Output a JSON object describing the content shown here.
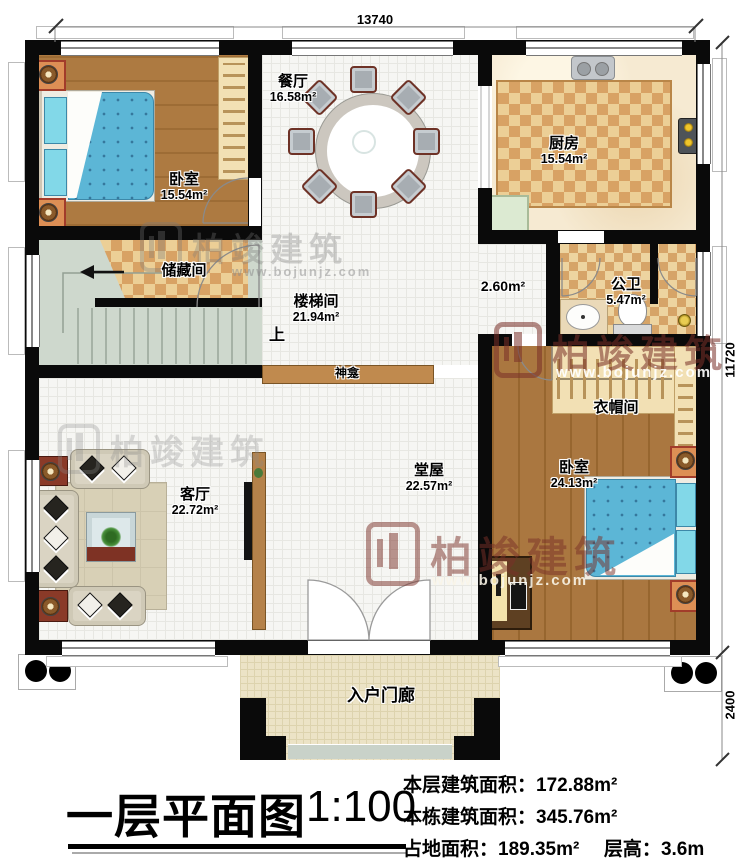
{
  "dimensions": {
    "top": "13740",
    "right_main": "11720",
    "right_porch": "2400"
  },
  "rooms": {
    "bedroom1": {
      "name": "卧室",
      "area": "15.54m²"
    },
    "dining": {
      "name": "餐厅",
      "area": "16.58m²"
    },
    "kitchen": {
      "name": "厨房",
      "area": "15.54m²"
    },
    "storage": {
      "name": "储藏间"
    },
    "stairwell": {
      "name": "楼梯间",
      "area": "21.94m²"
    },
    "corridor": {
      "area": "2.60m²"
    },
    "bathroom": {
      "name": "公卫",
      "area": "5.47m²"
    },
    "cloakroom": {
      "name": "衣帽间"
    },
    "bedroom2": {
      "name": "卧室",
      "area": "24.13m²"
    },
    "hall": {
      "name": "堂屋",
      "area": "22.57m²"
    },
    "living": {
      "name": "客厅",
      "area": "22.72m²"
    },
    "porch": {
      "name": "入户门廊"
    }
  },
  "annotations": {
    "up": "上",
    "shrine": "神龛"
  },
  "watermark": {
    "brand": "柏竣建筑",
    "url": "www.bojunjz.com"
  },
  "titleblock": {
    "title": "一层平面图",
    "scale": "1:100",
    "stat1_label": "本层建筑面积：",
    "stat1_value": "172.88m²",
    "stat2_label": "本栋建筑面积：",
    "stat2_value": "345.76m²",
    "stat3_label": "占地面积：",
    "stat3_value": "189.35m²",
    "stat4_label": "层高：",
    "stat4_value": "3.6m"
  },
  "colors": {
    "wall": "#0a0a0a",
    "wood": "#aa7740",
    "checker_dark": "#d8a264",
    "stair": "#ced8cd",
    "bed_blue": "#5cb6d6",
    "watermark_red": "#7a3028"
  }
}
